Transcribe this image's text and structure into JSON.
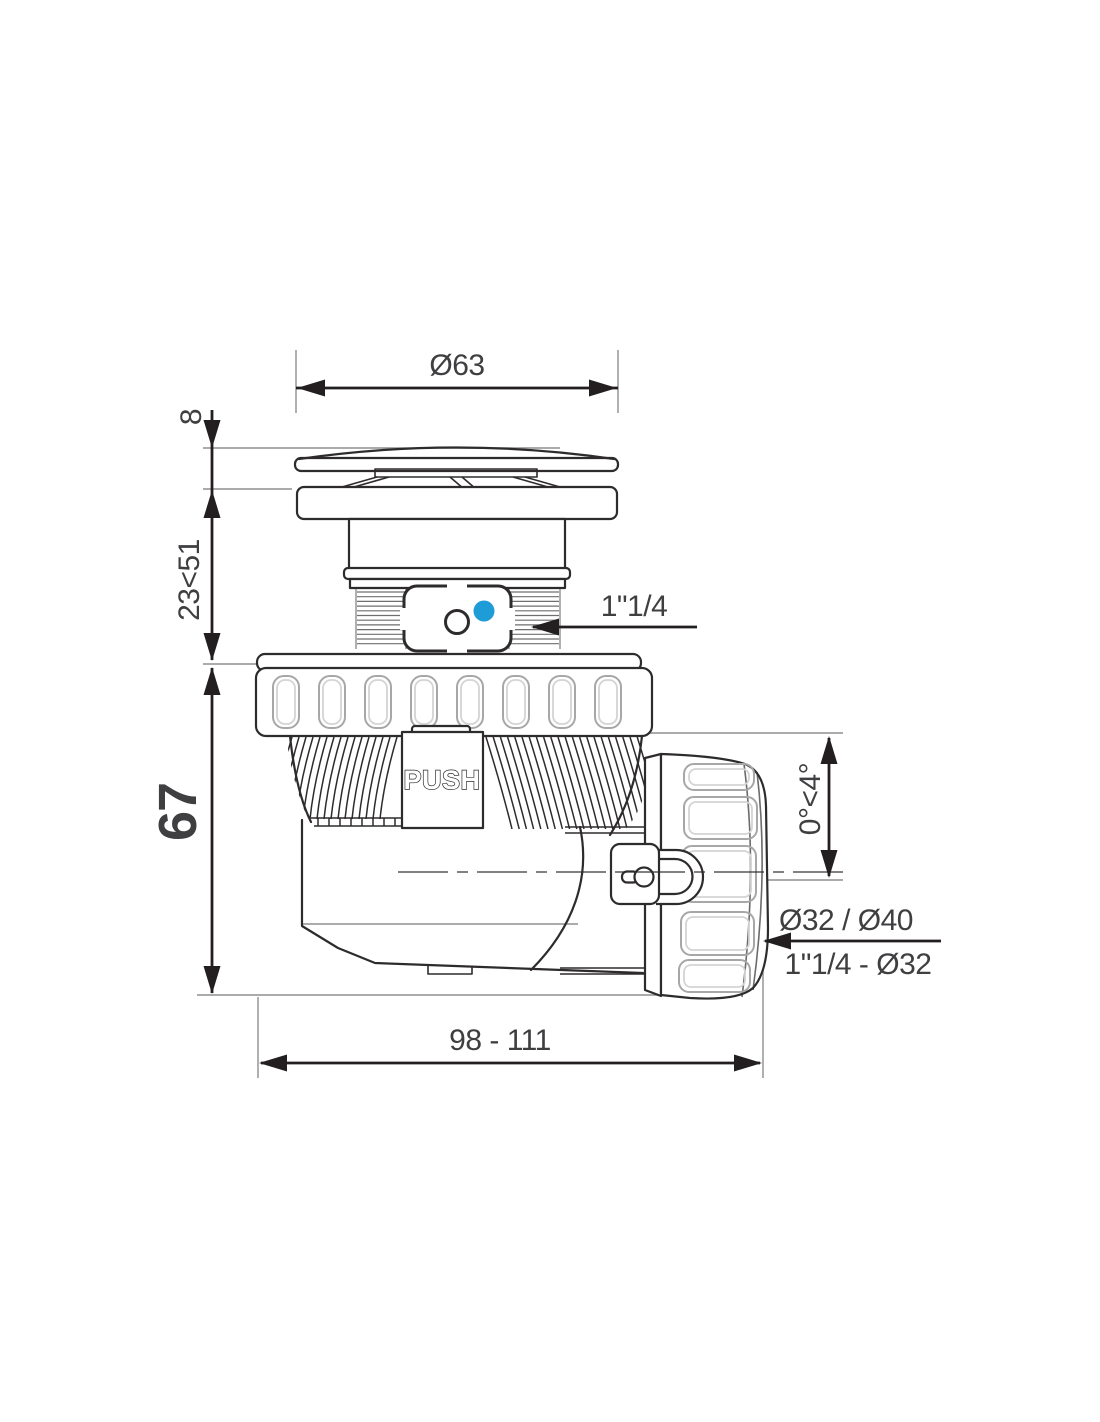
{
  "diagram": {
    "push_button_label": "PUSH",
    "dimensions": {
      "cap_diameter": "Ø63",
      "cap_height": "8",
      "neck_adjustable_height": "23<51",
      "body_height": "67",
      "inlet_thread": "1\"1/4",
      "outlet_tilt_angle": "0°<4°",
      "outlet_pipe_diameters": "Ø32 / Ø40",
      "outlet_thread_reduction": "1\"1/4 - Ø32",
      "overall_length": "98 - 111"
    },
    "colors": {
      "line": "#2e2b2c",
      "dim_line": "#231f20",
      "text": "#3f3e40",
      "thin_ref": "#8f8f8f",
      "slot_light": "#a7a7a7",
      "accent_blue": "#1e9cd8",
      "background": "#ffffff"
    }
  }
}
